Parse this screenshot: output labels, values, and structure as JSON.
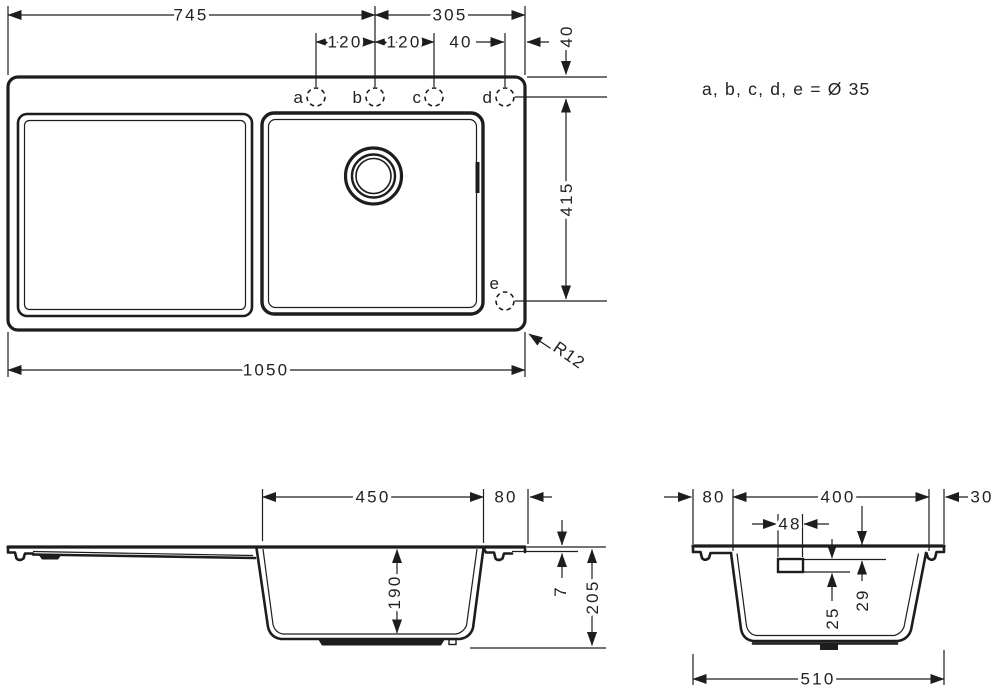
{
  "note": "a, b, c, d, e = Ø 35",
  "top_view": {
    "dim_left": "745",
    "dim_right": "305",
    "dim_ab": "120",
    "dim_bc": "120",
    "dim_d_edge": "40",
    "dim_top_edge": "40",
    "dim_height": "415",
    "dim_total": "1050",
    "radius": "R12",
    "holes": {
      "a": "a",
      "b": "b",
      "c": "c",
      "d": "d",
      "e": "e"
    }
  },
  "side_view": {
    "dim_basin": "450",
    "dim_right": "80",
    "dim_depth": "190",
    "dim_rim": "7",
    "dim_height": "205"
  },
  "section_view": {
    "dim_left": "80",
    "dim_basin": "400",
    "dim_right": "30",
    "dim_overflow_width": "48",
    "dim_overflow_height": "25",
    "dim_overflow_top": "29",
    "dim_total": "510"
  },
  "colors": {
    "line": "#1d1d1d",
    "background": "#ffffff"
  }
}
